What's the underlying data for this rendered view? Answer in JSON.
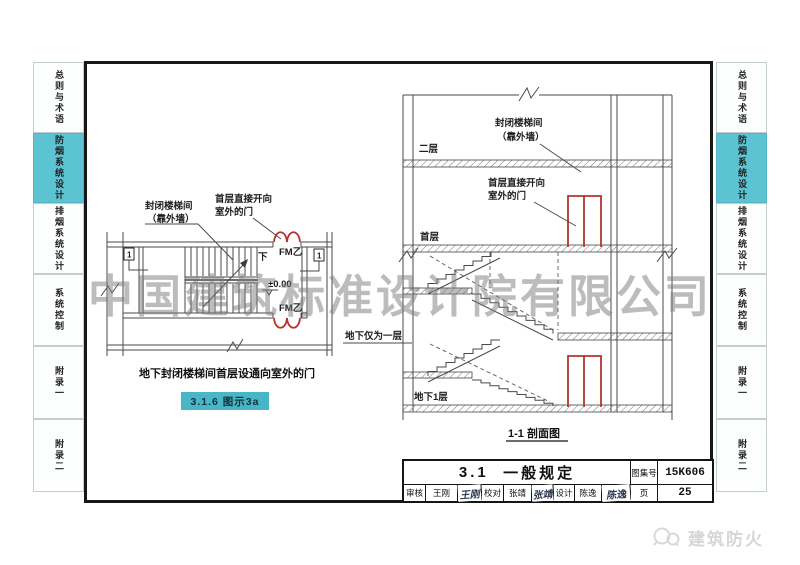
{
  "page": {
    "background": "#ffffff",
    "frame_color": "#171717"
  },
  "sidebar": {
    "highlight_color": "#5cc3d3",
    "items": [
      {
        "label": "总则与术语",
        "active": false
      },
      {
        "label": "防烟系统设计",
        "active": true
      },
      {
        "label": "排烟系统设计",
        "active": false
      },
      {
        "label": "系统控制",
        "active": false
      },
      {
        "label": "附录一",
        "active": false
      },
      {
        "label": "附录二",
        "active": false
      }
    ]
  },
  "watermark": {
    "text": "中国建筑标准设计院有限公司",
    "color": "#7a7a7a"
  },
  "plan_figure": {
    "label_stairwell_line1": "封闭楼梯间",
    "label_stairwell_line2": "（靠外墙）",
    "label_door_line1": "首层直接开向",
    "label_door_line2": "室外的门",
    "door_tag_top": "FM乙",
    "door_tag_bottom": "FM乙",
    "elevation": "±0.00",
    "down_label": "下",
    "section_marker_left": "1",
    "section_marker_right": "1",
    "caption": "地下封闭楼梯间首层设通向室外的门",
    "badge": "3.1.6 图示3a",
    "badge_color": "#49b6c8",
    "door_color": "#b5342f"
  },
  "section_figure": {
    "label_stairwell_line1": "封闭楼梯间",
    "label_stairwell_line2": "（靠外墙）",
    "label_door_line1": "首层直接开向",
    "label_door_line2": "室外的门",
    "floor_2": "二层",
    "floor_1": "首层",
    "floor_b1": "地下1层",
    "note_basement": "地下仅为一层",
    "caption": "1-1 剖面图"
  },
  "title_block": {
    "section_no": "3.1",
    "section_title": "一般规定",
    "atlas_label": "图集号",
    "atlas_no": "15K606",
    "page_label": "页",
    "page_no": "25",
    "review_label": "审核",
    "review_name": "王刚",
    "review_sign": "王刚",
    "check_label": "校对",
    "check_name": "张靖",
    "check_sign": "张靖",
    "design_label": "设计",
    "design_name": "陈逸",
    "design_sign": "陈逸"
  },
  "footer_logo": {
    "text": "建筑防火"
  }
}
